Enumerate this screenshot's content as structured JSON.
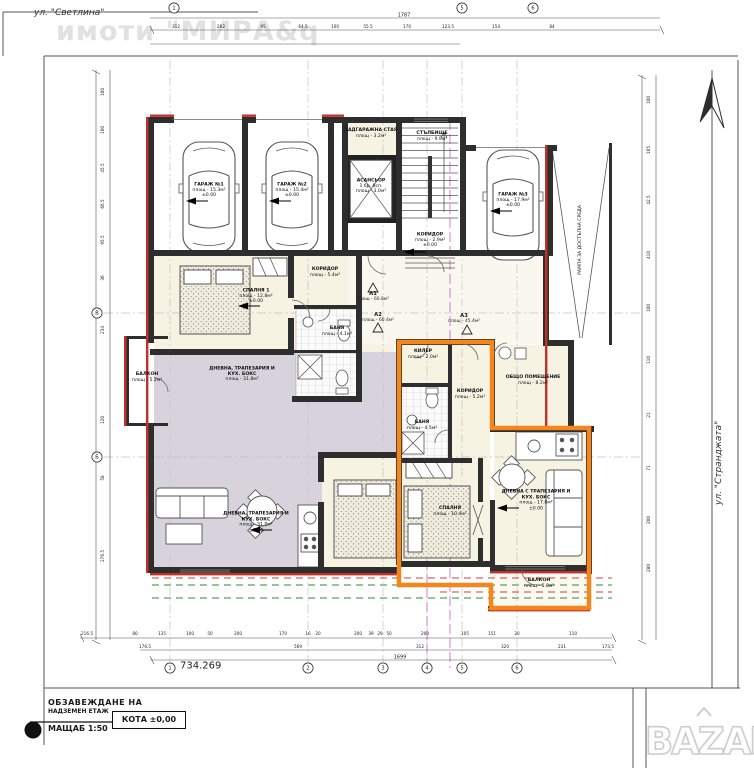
{
  "streets": {
    "top": "ул. \"Светлина\"",
    "right": "ул. \"Странджата\""
  },
  "watermarks": {
    "agency": "имоти \"МИРА&q",
    "portal": "BAZAR"
  },
  "title_block": {
    "line1": "ОБЗАВЕЖДАНЕ НА",
    "line2": "НАДЗЕМЕН ЕТАЖ",
    "scale": "МАЩАБ 1:50",
    "level": "КОТА ±0,00"
  },
  "datum": "734.269",
  "rooms": [
    {
      "id": "garage-1",
      "name": "ГАРАЖ №1",
      "area": "площ - 15.3м²",
      "elev": "±0.00"
    },
    {
      "id": "garage-2",
      "name": "ГАРАЖ №2",
      "area": "площ - 15.4м²",
      "elev": "±0.00"
    },
    {
      "id": "garage-3",
      "name": "ГАРАЖ №3",
      "area": "площ - 17.9м²",
      "elev": "±0.00"
    },
    {
      "id": "zadgarazhna-staya",
      "name": "ЗАДГАРАЖНА СТАЯ",
      "area": "площ - 3.2м²"
    },
    {
      "id": "stalbishte",
      "name": "СТЪЛБИЩЕ",
      "area": "площ - 9.9м²"
    },
    {
      "id": "asansior",
      "name": "АСАНСЬОР",
      "detail": "1 бр. 8сп.",
      "area": "площ - 3.0м²"
    },
    {
      "id": "koridor-vhod",
      "name": "КОРИДОР",
      "area": "площ - 2.9м²",
      "elev": "±0.00"
    },
    {
      "id": "rampa",
      "name": "РАМПА ЗА ДОСТЪПНА СРЕДА"
    },
    {
      "id": "spalnya-1",
      "name": "СПАЛНЯ 1",
      "area": "площ - 12.8м²",
      "elev": "±0.00"
    },
    {
      "id": "koridor-a2",
      "name": "КОРИДОР",
      "area": "площ - 5.4м²"
    },
    {
      "id": "banya-a2",
      "name": "БАНЯ",
      "area": "площ - 4.1м²"
    },
    {
      "id": "balkon-a2",
      "name": "БАЛКОН",
      "area": "площ - 5.2м²"
    },
    {
      "id": "dnevna-a2",
      "name": "ДНЕВНА, ТРАПЕЗАРИЯ И КУХ. БОКС",
      "area": "площ - 31.8м²",
      "elev": "±0.00"
    },
    {
      "id": "kiler",
      "name": "КИЛЕР",
      "area": "площ - 2.0м²"
    },
    {
      "id": "koridor-a3",
      "name": "КОРИДОР",
      "area": "площ - 5.2м²"
    },
    {
      "id": "banya-a3",
      "name": "БАНЯ",
      "area": "площ - 4.5м²"
    },
    {
      "id": "obshto-pomeshtenie",
      "name": "ОБЩО ПОМЕЩЕНИЕ",
      "area": "площ - 8.2м²"
    },
    {
      "id": "spalnya-a3",
      "name": "СПАЛНЯ",
      "area": "площ - 10.4м²"
    },
    {
      "id": "dnevna-a3",
      "name": "ДНЕВНА С ТРАПЕЗАРИЯ И КУХ. БОКС",
      "area": "площ - 17.8м²",
      "elev": "±0.00"
    },
    {
      "id": "balkon-a3",
      "name": "БАЛКОН",
      "area": "площ - 5.8м²"
    }
  ],
  "apartments": [
    {
      "label": "А1",
      "area": "площ - 60.8м²"
    },
    {
      "label": "А2",
      "area": "площ - 60.4м²"
    },
    {
      "label": "А3",
      "area": "площ - 45.4м²"
    }
  ],
  "grid": {
    "bottom": [
      "1",
      "2",
      "3",
      "4",
      "5",
      "6"
    ],
    "top": [
      "1",
      "5",
      "6"
    ],
    "left": [
      "Б",
      "В"
    ]
  },
  "dimensions": {
    "top_total": "1787",
    "top": [
      "312",
      "262",
      "95",
      "64.5",
      "100",
      "55.5",
      "170",
      "123.5",
      "154",
      "84"
    ],
    "bottom": [
      "216.5",
      "80",
      "135",
      "100",
      "50",
      "200",
      "170",
      "16",
      "20",
      "200",
      "39",
      "29",
      "50",
      "200",
      "105",
      "151",
      "20",
      "110"
    ],
    "bottom_sub": [
      "176.5",
      "569",
      "312",
      "320",
      "231",
      "173.5"
    ],
    "bottom_total": "1699",
    "left": [
      "100",
      "160",
      "45.5",
      "66.5",
      "95.5",
      "36",
      "234",
      "120",
      "58",
      "276.5"
    ],
    "right": [
      "100",
      "105",
      "42.5",
      "410",
      "100",
      "110",
      "21",
      "71",
      "200",
      "280"
    ]
  },
  "colors": {
    "highlight_orange": "#f5861d",
    "wall_red": "#c23028",
    "floor_cream": "#f6f3e3",
    "floor_lavender": "#d8d2dd"
  }
}
